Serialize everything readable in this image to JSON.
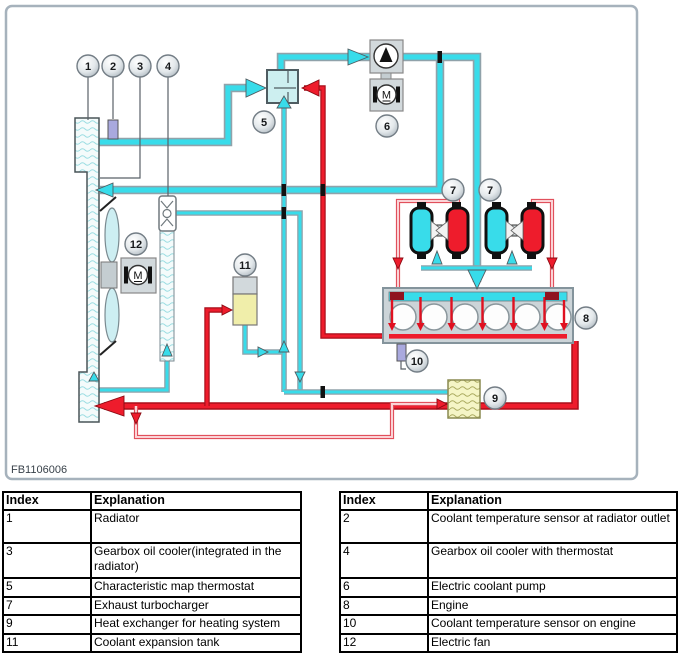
{
  "diagram": {
    "figure_code": "FB1106006",
    "motor_label": "M",
    "badges": [
      "1",
      "2",
      "3",
      "4",
      "5",
      "6",
      "7",
      "8",
      "9",
      "10",
      "11",
      "12"
    ]
  },
  "legend": {
    "headers": {
      "index": "Index",
      "explanation": "Explanation"
    },
    "left_rows": [
      {
        "index": "1",
        "text": "Radiator"
      },
      {
        "index": "3",
        "text": "Gearbox oil cooler(integrated in the radiator)"
      },
      {
        "index": "5",
        "text": "Characteristic map thermostat"
      },
      {
        "index": "7",
        "text": "Exhaust turbocharger"
      },
      {
        "index": "9",
        "text": "Heat exchanger for heating system"
      },
      {
        "index": "11",
        "text": "Coolant expansion tank"
      }
    ],
    "right_rows": [
      {
        "index": "2",
        "text": "Coolant temperature sensor at radiator outlet"
      },
      {
        "index": "4",
        "text": "Gearbox oil cooler with thermostat"
      },
      {
        "index": "6",
        "text": "Electric coolant pump"
      },
      {
        "index": "8",
        "text": "Engine"
      },
      {
        "index": "10",
        "text": "Coolant temperature sensor on engine"
      },
      {
        "index": "12",
        "text": "Electric fan"
      }
    ]
  },
  "colors": {
    "coolant_cold": "#38dcea",
    "coolant_hot": "#ee1c2c",
    "component_gray": "#ccd3d6",
    "thermostat_fill": "#cdeff0",
    "tank_yellow": "#f0eeaa",
    "heat_exchanger_yellow": "#f5f5c6",
    "sensor_violet": "#a9a9de",
    "frame_border": "#a6b2bc"
  }
}
